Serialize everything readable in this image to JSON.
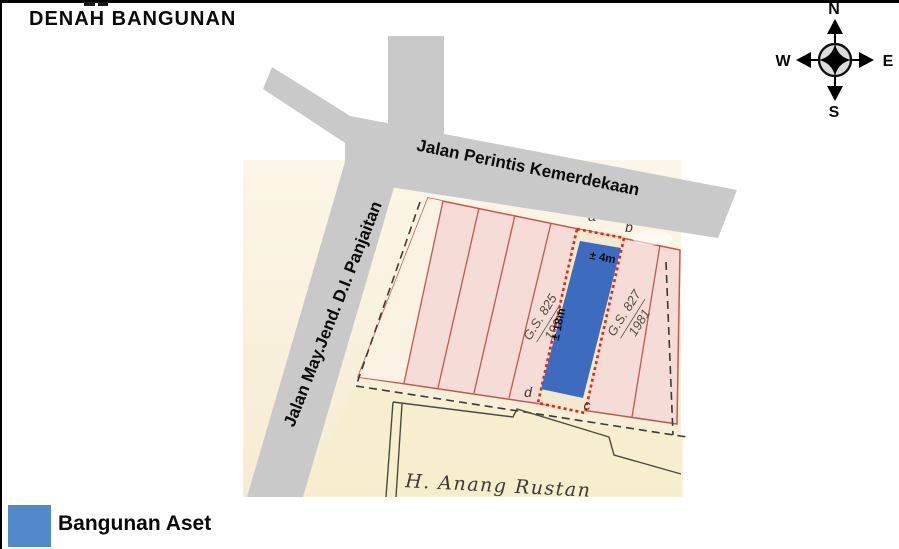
{
  "title": "DENAH BANGUNAN",
  "compass": {
    "n": "N",
    "e": "E",
    "s": "S",
    "w": "W"
  },
  "roads": {
    "top": "Jalan Perintis Kemerdekaan",
    "left": "Jalan May.Jend. D.I. Panjaitan"
  },
  "map": {
    "building": {
      "width_label": "± 4m",
      "length_label": "± 18m"
    },
    "corner_letters": {
      "a": "a",
      "b": "b",
      "c": "c",
      "d": "d"
    },
    "parcels": [
      {
        "gs": "G.S. 825",
        "year": "1987"
      },
      {
        "gs": "G.S. 827",
        "year": "1981"
      }
    ],
    "owner": "H. Anang Rustan"
  },
  "legend": {
    "label": "Bangunan Aset"
  },
  "colors": {
    "road_gray": "#C9C9C9",
    "paper_cream": "#F8F0DC",
    "parcel_pink": "#F6DCD6",
    "parcel_line_red": "#C4564E",
    "building_blue": "#3D6CBE",
    "legend_blue": "#5289CB",
    "dotted_border_red": "#E0251B"
  }
}
